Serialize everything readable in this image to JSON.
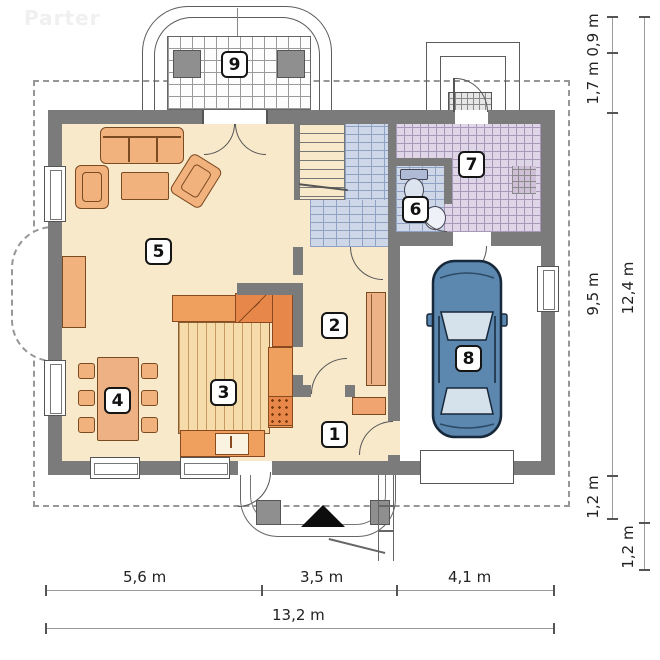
{
  "watermark": "Parter",
  "room_labels": {
    "r1": "1",
    "r2": "2",
    "r3": "3",
    "r4": "4",
    "r5": "5",
    "r6": "6",
    "r7": "7",
    "r8": "8",
    "r9": "9"
  },
  "dimensions": {
    "bottom_segments": [
      "5,6 m",
      "3,5 m",
      "4,1 m"
    ],
    "bottom_total": "13,2 m",
    "right_inner_segments": [
      "0,9 m",
      "1,7 m",
      "9,5 m",
      "1,2 m"
    ],
    "right_outer_segments": [
      "12,4 m",
      "1,2 m"
    ]
  },
  "colors": {
    "wall": "#7b7b7b",
    "floor_beige": "#f8e9cb",
    "furniture_orange": "#f2b27e",
    "kitchen_counter": "#f0a05e",
    "tile_blue": "#cdd7e8",
    "tile_lavender": "#ded6e7",
    "car_body": "#5c87ae",
    "garage_floor": "#ffffff"
  }
}
